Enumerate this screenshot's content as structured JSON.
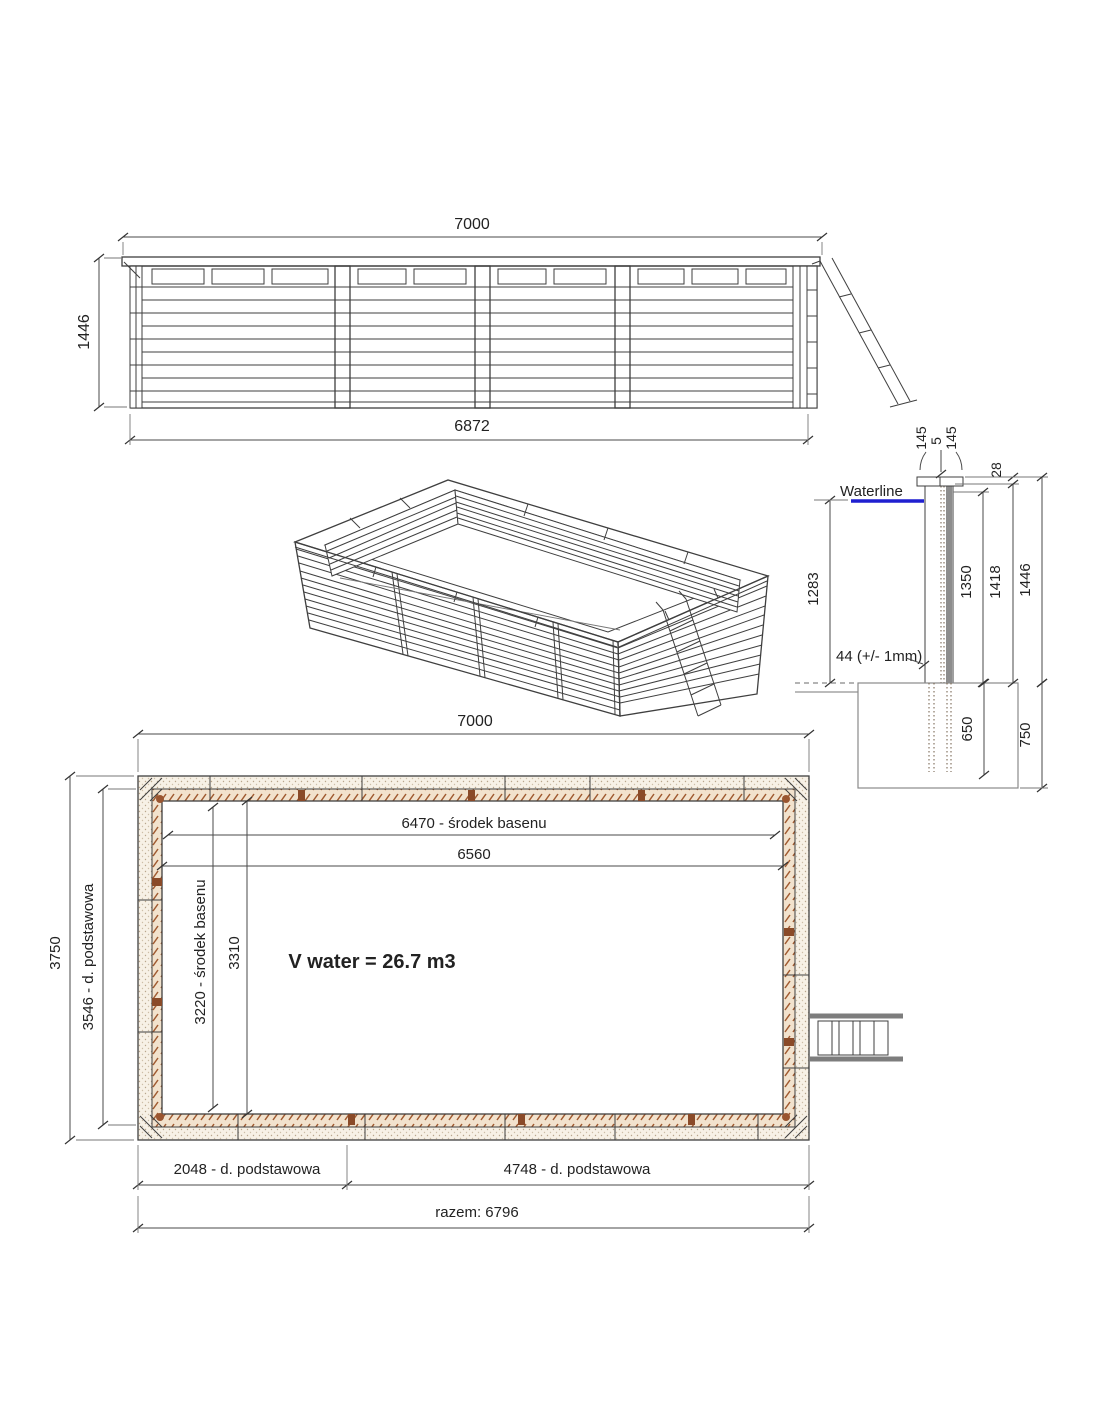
{
  "colors": {
    "line": "#3f3f3f",
    "waterline_blue": "#1f1fd0",
    "wood_brown": "#9a5530",
    "light_band": "#f6f0e5",
    "footing_gray": "#8a8a8a"
  },
  "views": {
    "elevation": {
      "dim_width_top": "7000",
      "dim_height_left": "1446",
      "dim_width_bottom": "6872"
    },
    "section": {
      "waterline_label": "Waterline",
      "dim_cap_board_left": "145",
      "dim_cap_gap": "5",
      "dim_cap_board_right": "145",
      "dim_cap_rise": "28",
      "dim_water_depth": "1283",
      "dim_wall_boards": "1350",
      "dim_wall_under_cap": "1418",
      "dim_wall_total": "1446",
      "note_plank_thickness": "44 (+/- 1mm)",
      "dim_post_embed": "650",
      "dim_footing_depth": "750"
    },
    "plan": {
      "dim_width_top": "7000",
      "dim_height_outer": "3750",
      "dim_height_base": "3546 - d. podstawowa",
      "dim_inner_center_width": "3220 - środek basenu",
      "dim_inner_width": "3310",
      "dim_inner_center_length": "6470 - środek basenu",
      "dim_inner_length": "6560",
      "volume_label": "V water = 26.7 m3",
      "dim_base_left": "2048 - d. podstawowa",
      "dim_base_right": "4748 - d. podstawowa",
      "dim_total": "razem: 6796"
    }
  }
}
